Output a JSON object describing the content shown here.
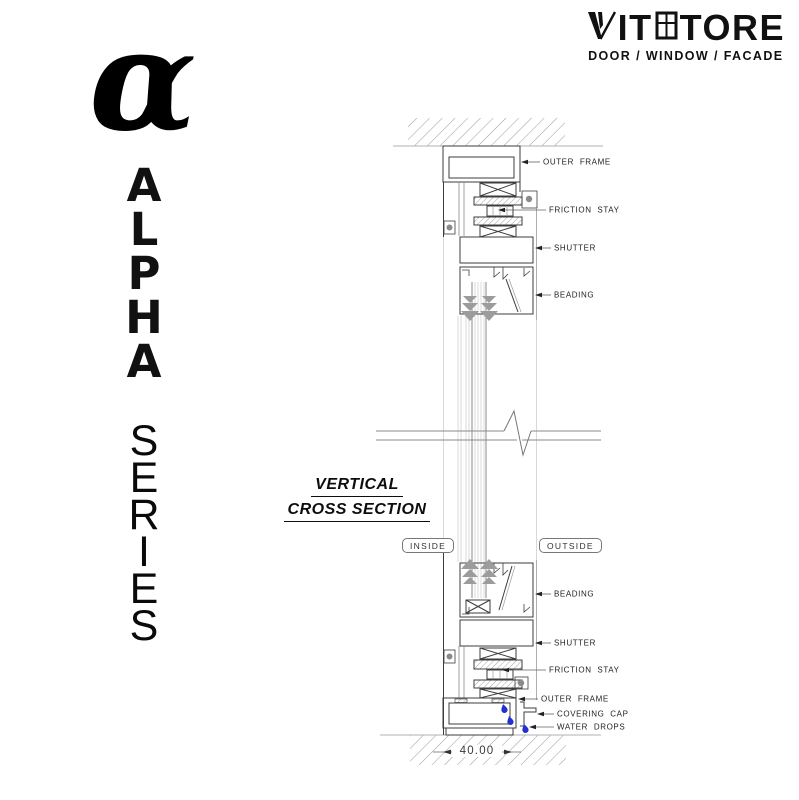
{
  "logo": {
    "brand_prefix": "IT",
    "brand_suffix": "TORE",
    "subtitle": "DOOR / WINDOW / FACADE"
  },
  "branding": {
    "alpha_symbol": "α",
    "alpha_letters": [
      "A",
      "L",
      "P",
      "H",
      "A"
    ],
    "series_letters": [
      "S",
      "E",
      "R",
      "I",
      "E",
      "S"
    ]
  },
  "drawing": {
    "title_line1": "VERTICAL",
    "title_line2": "CROSS SECTION",
    "inside_badge": "INSIDE",
    "outside_badge": "OUTSIDE",
    "dimension_value": "40.00",
    "labels_top": [
      {
        "text": "OUTER FRAME"
      },
      {
        "text": "FRICTION STAY"
      },
      {
        "text": "SHUTTER"
      },
      {
        "text": "BEADING"
      }
    ],
    "labels_bottom": [
      {
        "text": "BEADING"
      },
      {
        "text": "SHUTTER"
      },
      {
        "text": "FRICTION STAY"
      },
      {
        "text": "OUTER FRAME"
      },
      {
        "text": "COVERING CAP"
      },
      {
        "text": "WATER DROPS"
      }
    ],
    "icons": {
      "logo_mark": "stylized-v-mark",
      "window": "window-grid-icon",
      "water_drop": "water-drop"
    },
    "colors": {
      "ink": "#111111",
      "profile_line": "#3d3d3d",
      "light_line": "#cfcfcf",
      "water_drop_blue": "#2431d1"
    }
  }
}
